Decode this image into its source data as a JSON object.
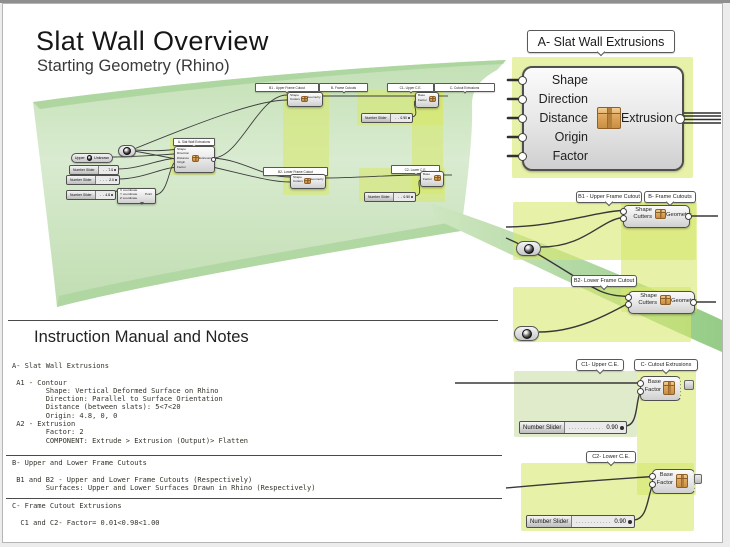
{
  "header": {
    "title": "Slat Wall Overview",
    "subtitle": "Starting Geometry (Rhino)"
  },
  "detail_a": {
    "callout": "A- Slat Wall Extrusions",
    "inputs": [
      "Shape",
      "Direction",
      "Distance",
      "Origin",
      "Factor"
    ],
    "output": "Extrusion"
  },
  "detail_b1": {
    "callout_left": "B1 - Upper Frame Cutout",
    "callout_right": "B- Frame Cutouts",
    "input_top": "Shape",
    "input_bottom": "Cutters",
    "output": "Geometry"
  },
  "detail_b2": {
    "callout": "B2- Lower Frame Cutout",
    "input_top": "Shape",
    "input_bottom": "Cutters",
    "output": "Geometry"
  },
  "detail_c1": {
    "callout_left": "C1- Upper C.E.",
    "callout_right": "C- Cutout Extrusions",
    "input_top": "Base",
    "input_bottom": "Factor",
    "slider_label": "Number Slider",
    "slider_value": "0.90"
  },
  "detail_c2": {
    "callout": "C2- Lower C.E.",
    "input_top": "Base",
    "input_bottom": "Factor",
    "slider_label": "Number Slider",
    "slider_value": "0.90"
  },
  "canvas": {
    "group_a_label": "A- Slat Wall Extrusions",
    "comp_a": {
      "inputs": [
        "Shape",
        "Direction",
        "Distance",
        "Origin",
        "Factor"
      ],
      "output": "Extrusion"
    },
    "param_pill": {
      "left": "Upper",
      "right": "Unknown"
    },
    "sliders": [
      {
        "label": "Number Slider",
        "value": "7.0"
      },
      {
        "label": "Number Slider",
        "value": "2.0"
      },
      {
        "label": "Number Slider",
        "value": "4.8"
      }
    ],
    "construct_point": {
      "rows": [
        "X coordinate",
        "Y coordinate",
        "Z coordinate"
      ],
      "output": "Point"
    },
    "label_b1": "B1 - Upper Frame Cutout",
    "label_b": "B- Frame Cutouts",
    "label_b2": "B2- Lower Frame Cutout",
    "label_c1": "C1- Upper C.E.",
    "label_c": "C- Cutout Extrusions",
    "label_c2": "C2- Lower C.E.",
    "comp_b1": {
      "input_top": "Shape",
      "input_bottom": "Cutters",
      "output": "Geometry"
    },
    "comp_b2": {
      "input_top": "Shape",
      "input_bottom": "Cutters",
      "output": "Geometry"
    },
    "comp_c1": {
      "input_top": "Base",
      "input_bottom": "Factor"
    },
    "comp_c2": {
      "input_top": "Base",
      "input_bottom": "Factor"
    },
    "slider_c1": {
      "label": "Number Slider",
      "value": "0.90"
    },
    "slider_c2": {
      "label": "Number Slider",
      "value": "0.90"
    }
  },
  "notes": {
    "heading": "Instruction Manual and Notes",
    "section_a": "A- Slat Wall Extrusions\n\n A1 - Contour\n        Shape: Vertical Deformed Surface on Rhino\n        Direction: Parallel to Surface Orientation\n        Distance (between slats): 5<7<20\n        Origin: 4.8, 0, 0\n A2 - Extrusion\n        Factor: 2\n        COMPONENT: Extrude > Extrusion (Output)> Flatten",
    "section_b": "B- Upper and Lower Frame Cutouts\n\n B1 and B2 - Upper and Lower Frame Cutouts (Respectively)\n        Surfaces: Upper and Lower Surfaces Drawn in Rhino (Respectively)",
    "section_c": "C- Frame Cutout Extrusions\n\n  C1 and C2- Factor= 0.01<0.98<1.00"
  },
  "colors": {
    "group_yellow": "#e4efa0",
    "surface_green": "#cfe6c3",
    "wire": "#3a3a3a",
    "package_icon": "#d79b50"
  }
}
